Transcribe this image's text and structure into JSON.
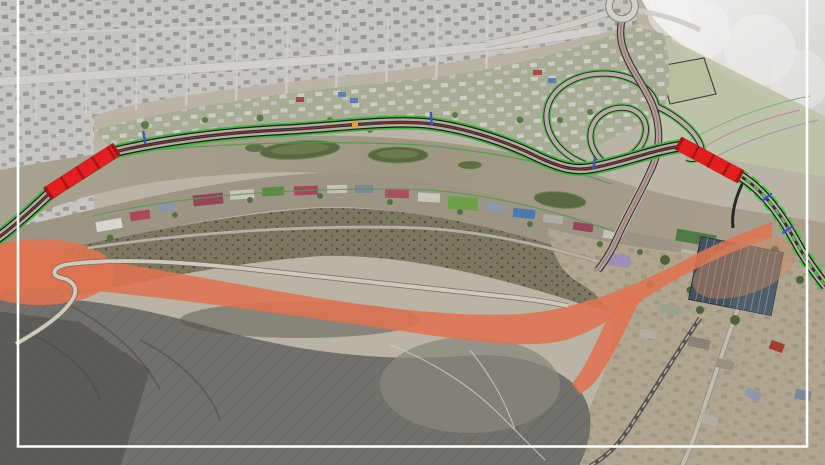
{
  "canvas": {
    "width": 825,
    "height": 465
  },
  "map": {
    "kind": "aerial-photomontage-masterplan",
    "description": "Satellite photomontage of a planned riverside highway project: two red-highlighted bridge sections crossing the river, a green-edged alignment along the north bank, a grade-separated interchange with loop ramps and a roundabout at top right, an orange-highlighted landslide/earthworks band on the opposite slope, desaturated city context at top left, dark mountain slope at bottom, and a thin white frame inset over the imagery.",
    "colors": {
      "frame_white": "#ffffff",
      "bridge_red": "#e31e1e",
      "bridge_red_joint": "#9c1414",
      "highway_green_edge": "#3cb53a",
      "descent_green": "#3ecb3c",
      "highway_casing_black": "#1e1d1b",
      "highway_surface_gray": "#b3ada1",
      "highway_center_red": "#8c3434",
      "chainage_marker_blue": "#3d55c0",
      "roadside_marker_orange": "#e09c3a",
      "ramp_road_pink": "#b59c98",
      "river_water_tan": "#a49e8b",
      "river_bank_green": "#4f9c4a",
      "island_olive": "#5a6840",
      "landslide_orange": "#df7351",
      "city_gray": "#c7c5c1",
      "fog_white": "#efeeec",
      "field_green": "#bdc4a6",
      "south_bank_olive": "#9c9583",
      "scrub_dark_olive": "#7b785f",
      "mountain_gray": "#71706a",
      "mountain_shadow": "#565550",
      "urban_tan": "#b0a58e",
      "industrial_roof_slate": "#43515d"
    },
    "features": [
      {
        "name": "planned-bridge-west",
        "kind": "bridge section highlighted red across the river",
        "color": "#e31e1e"
      },
      {
        "name": "planned-bridge-east",
        "kind": "bridge section highlighted red across the river",
        "color": "#e31e1e"
      },
      {
        "name": "riverside-highway-alignment",
        "kind": "new highway along north river bank with green edge lines",
        "color": "#3cb53a"
      },
      {
        "name": "interchange-loops",
        "kind": "grade-separated interchange with loop ramps"
      },
      {
        "name": "roundabout",
        "kind": "roundabout at the north approach road"
      },
      {
        "name": "north-approach-road",
        "kind": "existing road from roundabout crossing the river"
      },
      {
        "name": "chainage-markers",
        "kind": "blue station ticks on the alignment",
        "color": "#3d55c0"
      },
      {
        "name": "landslide-zone",
        "kind": "orange-highlighted unstable slope and earthworks band",
        "color": "#df7351"
      },
      {
        "name": "river",
        "kind": "river with vegetated islands"
      },
      {
        "name": "gray-city-context",
        "kind": "desaturated urban blocks outside the project corridor"
      },
      {
        "name": "industrial-warehouse",
        "kind": "large dark-roof industrial building, lower right",
        "color": "#43515d"
      },
      {
        "name": "mountain-slope",
        "kind": "dark rocky hillside, lower left"
      },
      {
        "name": "inset-frame",
        "kind": "thin white border inset over the imagery",
        "color": "#ffffff"
      }
    ]
  }
}
